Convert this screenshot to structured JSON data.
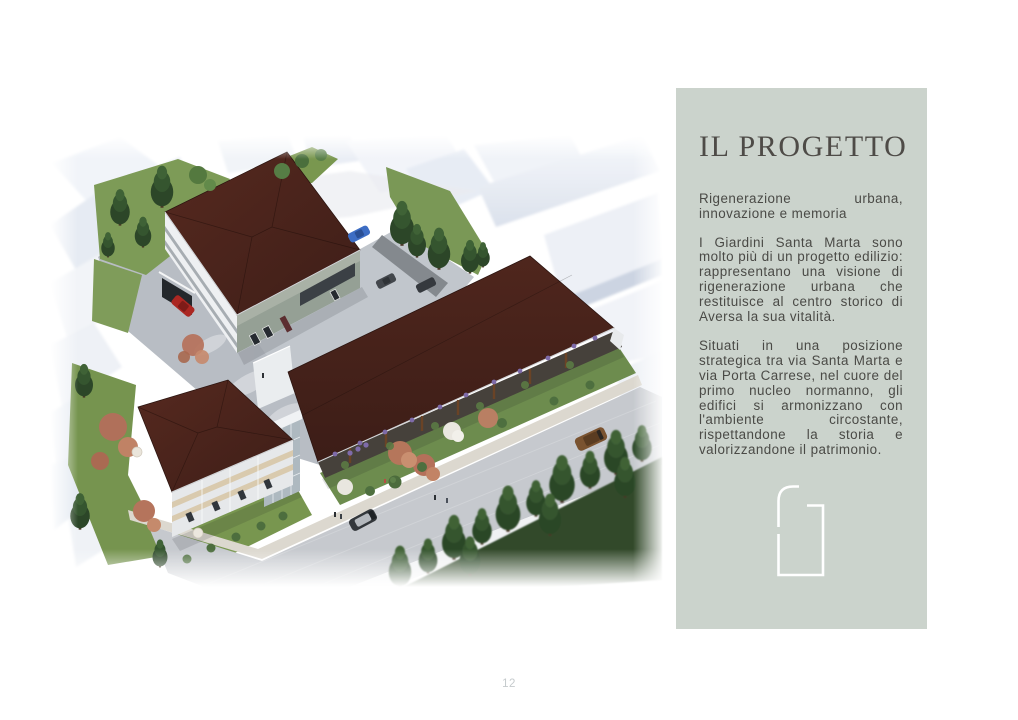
{
  "page": {
    "number": "12"
  },
  "palette": {
    "page_bg": "#ffffff",
    "panel_bg": "#cbd3cc",
    "title_color": "#4e4b47",
    "body_color": "#4a4a46",
    "page_number_color": "#c6cbcd",
    "roof_brown": "#4a241d",
    "logo_stroke": "#ffffff"
  },
  "panel": {
    "title": "IL PROGETTO",
    "subtitle": "Rigenerazione urbana, innovazione e memoria",
    "paragraphs": [
      "I Giardini Santa Marta sono molto più di un progetto edilizio: rappresentano una visione di rigenerazione urbana che restituisce al centro storico di Aversa la sua vitalità.",
      "Situati in una posizione strategica tra via Santa Marta e via Porta Carrese, nel cuore del primo nucleo normanno, gli edifici si armonizzano con l'ambiente circostante, rispettandone la storia e valorizzandone il patrimonio."
    ]
  }
}
